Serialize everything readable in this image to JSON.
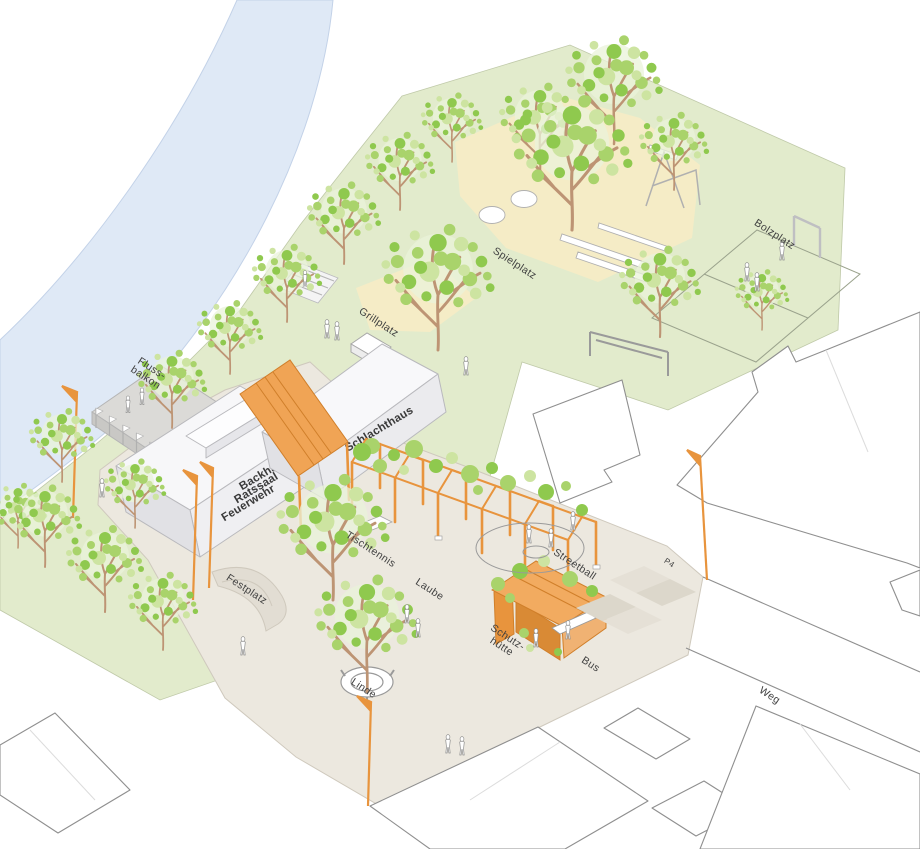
{
  "labels": {
    "flussbalkon": [
      "Fluss-",
      "balkon"
    ],
    "main_building": [
      "Backhaus",
      "Ratssaal",
      "Feuerwehr"
    ],
    "schlachthaus": "Schlachthaus",
    "grillplatz": "Grillplatz",
    "spielplatz": "Spielplatz",
    "bolzplatz": "Bolzplatz",
    "festplatz": "Festplatz",
    "linde": "Linde",
    "tischtennis": "Tischtennis",
    "laube": "Laube",
    "streetball": "Streetball",
    "schutzhuette": [
      "Schutz-",
      "hütte"
    ],
    "bus": "Bus",
    "parking": "P4",
    "weg": "Weg"
  },
  "colors": {
    "river": "#dfe9f6",
    "park_green": "#e2ebcc",
    "sand": "#f5ecc6",
    "plaza": "#ece8df",
    "structure_orange": "#e8943d",
    "foliage_green": "#a9d36b",
    "tree_trunk": "#bd9474",
    "outline_grey": "#8f8f8f",
    "label_text": "#3f3f3f"
  }
}
